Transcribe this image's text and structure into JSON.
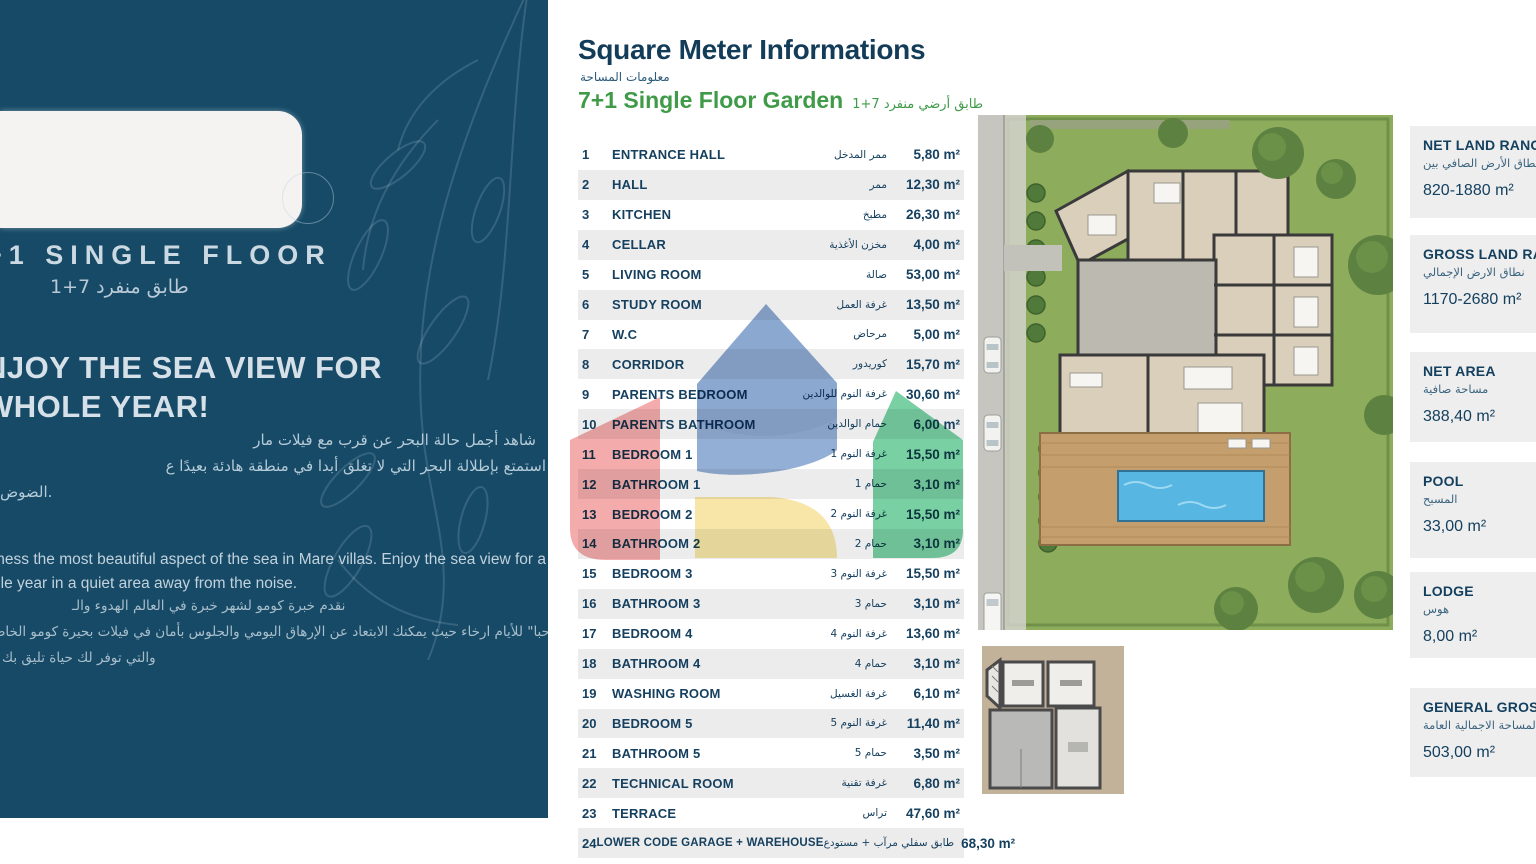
{
  "colors": {
    "panel_navy": "#164a67",
    "navy_text": "#16405f",
    "accent_green": "#3f9b48",
    "row_stripe": "#ececec",
    "box_bg": "#efeeee",
    "watermark_blue": "#6e92c6",
    "watermark_red": "#ee8a8a",
    "watermark_green": "#4cc084",
    "watermark_yellow": "#f5df8e",
    "pool_blue": "#58b6e3",
    "grass_green": "#8dac5c"
  },
  "left_panel": {
    "title_en": "+1 SINGLE FLOOR",
    "title_ar": "طابق منفرد 7+1",
    "headline_line1": "NJOY THE SEA VIEW FOR",
    "headline_line2": "WHOLE YEAR!",
    "ar_par1_line1": "شاهد أجمل حالة البحر عن قرب مع فيلات مار",
    "ar_par1_line2": "استمتع بإطلالة البحر التي لا تغلق أبدا في منطقة هادئة بعيدًا ع",
    "ar_par1_line3": ".الضوض",
    "en_par_line1": "tness the most beautiful aspect of the sea in Mare villas. Enjoy the sea view for a",
    "en_par_line2": "ole year in a quiet area away from the noise.",
    "ar_par2_line1": "نقدم خبرة كومو لشهر خبرة في العالم الهدوء والـ",
    "ar_par2_line2": "قل \"مرحبا\" للأيام ارخاء حيث يمكنك الابتعاد عن الإرهاق اليومي والجلوس بأمان في فيلات بحيرة كومو الخاصـ",
    "ar_par2_line3": "والتي توفر لك حياة تليق بك"
  },
  "header": {
    "title": "Square Meter Informations",
    "title_ar": "معلومات المساحة",
    "subtitle": "7+1 Single Floor Garden",
    "subtitle_ar": "طابق أرضي منفرد 7+1"
  },
  "table": {
    "rows": [
      {
        "no": "1",
        "name": "ENTRANCE HALL",
        "name_ar": "ممر المدخل",
        "value": "5,80 m²"
      },
      {
        "no": "2",
        "name": "HALL",
        "name_ar": "ممر",
        "value": "12,30 m²"
      },
      {
        "no": "3",
        "name": "KITCHEN",
        "name_ar": "مطبخ",
        "value": "26,30 m²"
      },
      {
        "no": "4",
        "name": "CELLAR",
        "name_ar": "مخزن الأغذية",
        "value": "4,00 m²"
      },
      {
        "no": "5",
        "name": "LIVING ROOM",
        "name_ar": "صالة",
        "value": "53,00 m²"
      },
      {
        "no": "6",
        "name": "STUDY ROOM",
        "name_ar": "غرفة العمل",
        "value": "13,50 m²"
      },
      {
        "no": "7",
        "name": "W.C",
        "name_ar": "مرحاض",
        "value": "5,00 m²"
      },
      {
        "no": "8",
        "name": "CORRIDOR",
        "name_ar": "كوريدور",
        "value": "15,70 m²"
      },
      {
        "no": "9",
        "name": "PARENTS BEDROOM",
        "name_ar": "غرفة النوم للوالدين",
        "value": "30,60 m²"
      },
      {
        "no": "10",
        "name": "PARENTS BATHROOM",
        "name_ar": "حمام الوالدين",
        "value": "6,00 m²"
      },
      {
        "no": "11",
        "name": "BEDROOM 1",
        "name_ar": "غرفة النوم 1",
        "value": "15,50 m²"
      },
      {
        "no": "12",
        "name": "BATHROOM 1",
        "name_ar": "حمام 1",
        "value": "3,10 m²"
      },
      {
        "no": "13",
        "name": "BEDROOM 2",
        "name_ar": "غرفة النوم 2",
        "value": "15,50 m²"
      },
      {
        "no": "14",
        "name": "BATHROOM 2",
        "name_ar": "حمام 2",
        "value": "3,10 m²"
      },
      {
        "no": "15",
        "name": "BEDROOM 3",
        "name_ar": "غرفة النوم 3",
        "value": "15,50 m²"
      },
      {
        "no": "16",
        "name": "BATHROOM 3",
        "name_ar": "حمام 3",
        "value": "3,10 m²"
      },
      {
        "no": "17",
        "name": "BEDROOM 4",
        "name_ar": "غرفة النوم 4",
        "value": "13,60 m²"
      },
      {
        "no": "18",
        "name": "BATHROOM 4",
        "name_ar": "حمام 4",
        "value": "3,10 m²"
      },
      {
        "no": "19",
        "name": "WASHING ROOM",
        "name_ar": "غرفة الغسيل",
        "value": "6,10 m²"
      },
      {
        "no": "20",
        "name": "BEDROOM 5",
        "name_ar": "غرفة النوم 5",
        "value": "11,40 m²"
      },
      {
        "no": "21",
        "name": "BATHROOM 5",
        "name_ar": "حمام 5",
        "value": "3,50 m²"
      },
      {
        "no": "22",
        "name": "TECHNICAL ROOM",
        "name_ar": "غرفة تقنية",
        "value": "6,80 m²"
      },
      {
        "no": "23",
        "name": "TERRACE",
        "name_ar": "تراس",
        "value": "47,60 m²"
      },
      {
        "no": "24",
        "name": "LOWER CODE GARAGE + WAREHOUSE",
        "name_ar": "طابق سفلي مرآب + مستودع",
        "value": "68,30 m²"
      }
    ]
  },
  "summary": {
    "boxes": [
      {
        "title": "NET LAND RANGE",
        "title_ar": "نطاق الأرض الصافي بين",
        "value": "820-1880 m²"
      },
      {
        "title": "GROSS LAND RANGE",
        "title_ar": "نطاق الارض الإجمالي",
        "value": "1170-2680 m²"
      },
      {
        "title": "NET AREA",
        "title_ar": "مساحة صافية",
        "value": "388,40 m²"
      },
      {
        "title": "POOL",
        "title_ar": "المسبح",
        "value": "33,00 m²"
      },
      {
        "title": "LODGE",
        "title_ar": "هوس",
        "value": "8,00 m²"
      },
      {
        "title": "GENERAL GROSS",
        "title_ar": "المساحة الاجمالية العامة",
        "value": "503,00 m²"
      }
    ]
  }
}
